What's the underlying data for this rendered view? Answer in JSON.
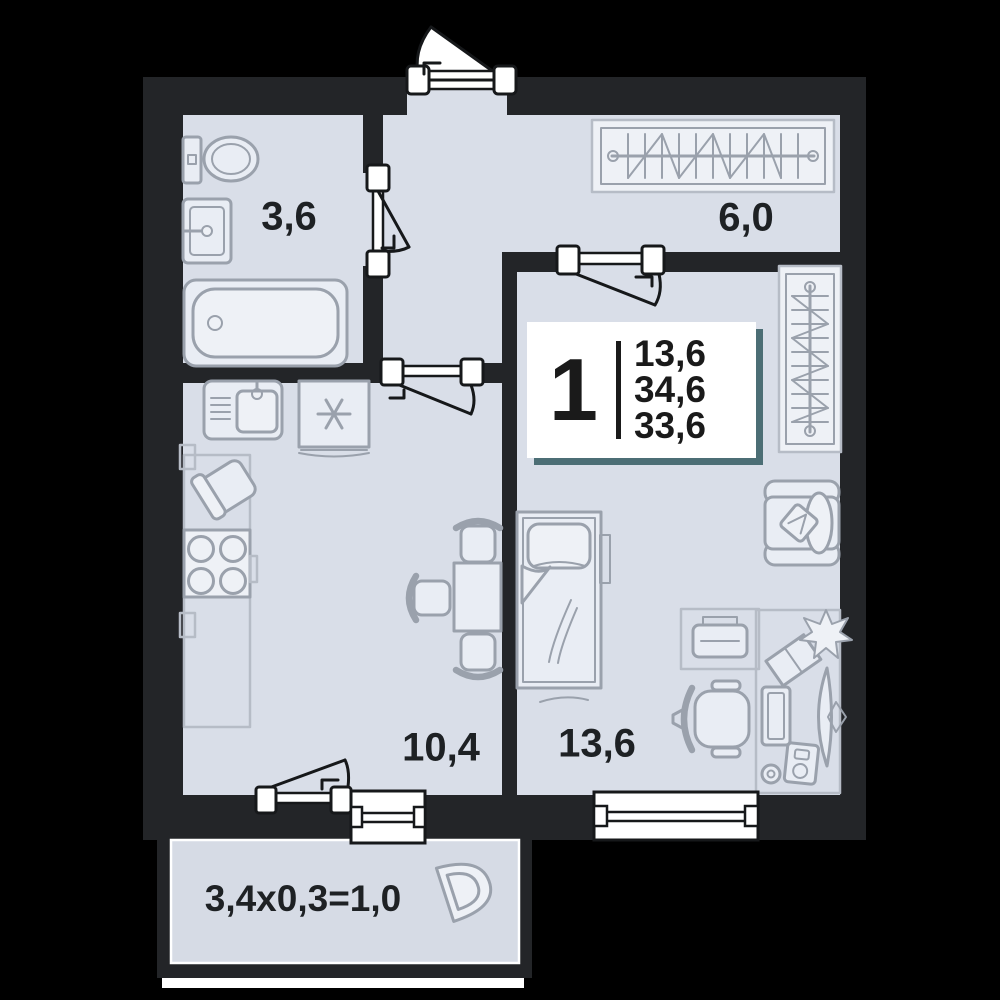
{
  "badge": {
    "rooms_count": "1",
    "area_living": "13,6",
    "area_total": "34,6",
    "area_reduced": "33,6"
  },
  "room_labels": {
    "bathroom": "3,6",
    "hallway": "6,0",
    "kitchen_living": "10,4",
    "bedroom": "13,6",
    "balcony": "3,4x0,3=1,0"
  },
  "colors": {
    "bg": "#000000",
    "wall": "#232528",
    "floor": "#d9dee8",
    "floor2": "#d6dbe5",
    "furn": "#9aa1ac",
    "furnlight": "#b6bcc6",
    "text": "#1e2124",
    "badge-shadow": "#4c6e75"
  }
}
